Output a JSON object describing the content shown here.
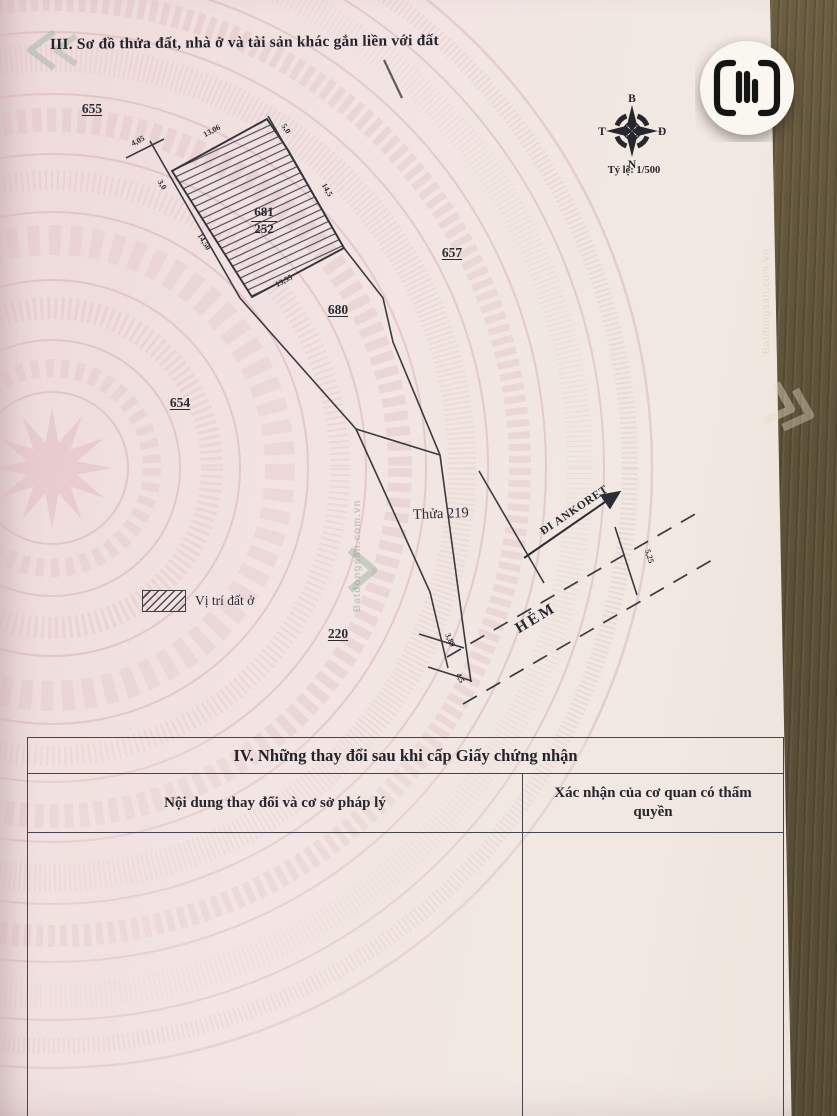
{
  "page": {
    "title_iii": "III. Sơ đồ thửa đất, nhà ở và tài sản khác gắn liền với đất",
    "compass": {
      "north": "B",
      "south": "N",
      "east": "Đ",
      "west": "T",
      "scale": "Tỷ lệ: 1/500"
    },
    "diagram": {
      "parcels": [
        "655",
        "657",
        "654",
        "680",
        "220"
      ],
      "highlight": {
        "lot": "681",
        "area": "252"
      },
      "neighbor_label": "Thửa 219",
      "road_label": "ĐI ANKORET",
      "alley_label": "HẺM",
      "dims": {
        "top_tick": "4,05",
        "hatch_top": "13,06",
        "hatch_top_right": "5,0",
        "hatch_right": "14,5",
        "strip_left": "3,0",
        "hatch_left": "14,50",
        "hatch_bottom": "13,55",
        "end_tick_a": "3,89",
        "end_tick_b": "4,5",
        "road_width": "5,25"
      }
    },
    "legend": {
      "label": "Vị trí đất ở"
    },
    "table_iv": {
      "title": "IV. Những thay đổi sau khi cấp Giấy chứng nhận",
      "col_left": "Nội dung thay đổi và cơ sở pháp lý",
      "col_right": "Xác nhận của cơ quan có thẩm quyền"
    },
    "watermark": {
      "brand": "Batdongsan.com.vn"
    },
    "colors": {
      "paper": "#f1e3e2",
      "drum": "#d8aeb4",
      "ink": "#2c2c34",
      "wood": "#5d5138",
      "badge": "#faf7f1"
    }
  }
}
